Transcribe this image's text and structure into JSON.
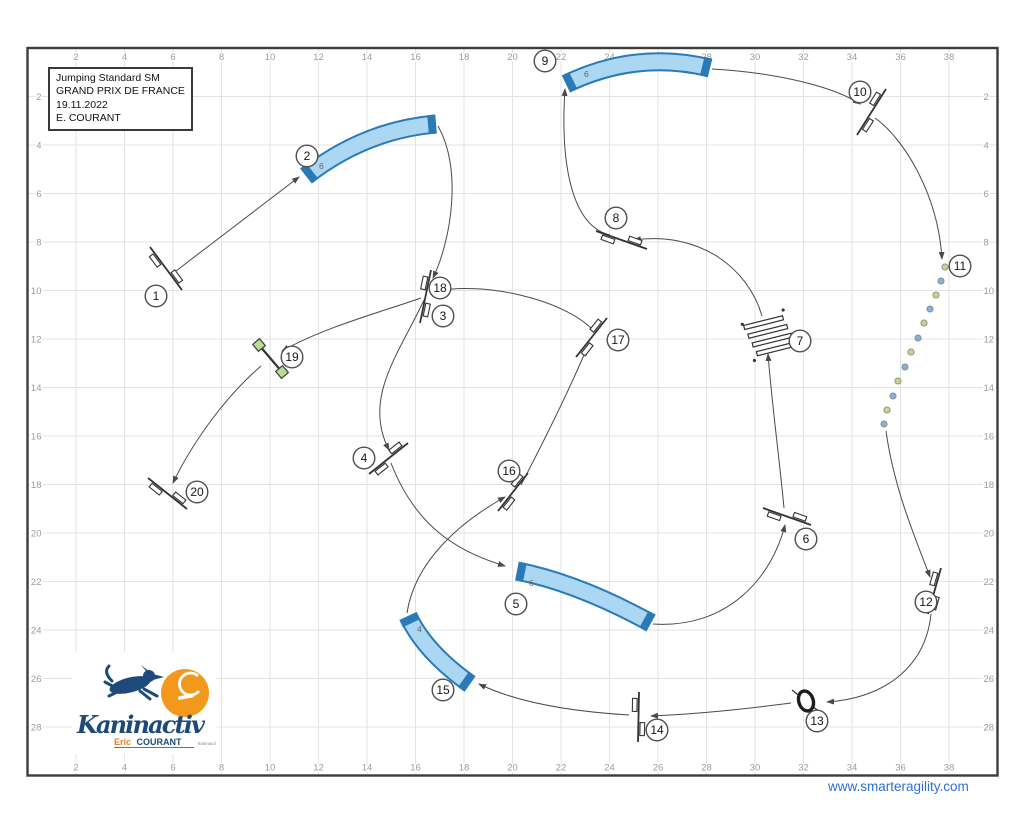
{
  "title_block": {
    "lines": [
      "Jumping Standard SM",
      "GRAND PRIX DE FRANCE",
      "19.11.2022",
      "E. COURANT"
    ]
  },
  "footer": {
    "website": "www.smarteragility.com"
  },
  "logo": {
    "name": "Kaninactiv",
    "subtitle_first": "Eric",
    "subtitle_last": "COURANT",
    "tagline": "kaninactiv"
  },
  "colors": {
    "frame": "#3c3c3c",
    "grid": "#e3e3e3",
    "axis_text": "#9b9b9b",
    "path": "#4a4a4a",
    "tunnel_fill": "#abd7f3",
    "tunnel_edge": "#2a7ab8",
    "tunnel_label": "#666666",
    "weave_green": "#c8d489",
    "weave_blue": "#82b1d9",
    "wall_green": "#b9dc92",
    "circle_stroke": "#4e4e4e",
    "circle_text": "#161616",
    "link_blue": "#2e6fd6",
    "logo_navy": "#1d4a7a",
    "logo_orange": "#f2991d"
  },
  "course": {
    "origin_x": 27.5,
    "origin_y": 48,
    "meter_px": 24.25,
    "width_m": 40,
    "height_m": 30,
    "x_ticks": [
      2,
      4,
      6,
      8,
      10,
      12,
      14,
      16,
      18,
      20,
      22,
      24,
      26,
      28,
      30,
      32,
      34,
      36,
      38
    ],
    "y_ticks": [
      2,
      4,
      6,
      8,
      10,
      12,
      14,
      16,
      18,
      20,
      22,
      24,
      26,
      28
    ],
    "legs": [
      {
        "from": "1",
        "to": "2",
        "d": "M176,271 L299,177"
      },
      {
        "from": "2",
        "to": "3",
        "d": "M438,126 C462,168 452,238 433,278"
      },
      {
        "from": "3",
        "to": "4",
        "d": "M424,300 C400,352 362,398 389,450"
      },
      {
        "from": "4",
        "to": "5",
        "d": "M391,463 C415,525 455,551 505,566"
      },
      {
        "from": "5",
        "to": "6",
        "d": "M653,624 C728,629 772,577 785,525"
      },
      {
        "from": "6",
        "to": "7",
        "d": "M784,508 C779,455 772,405 768,354"
      },
      {
        "from": "7",
        "to": "8",
        "d": "M762,316 C748,268 700,231 634,240"
      },
      {
        "from": "8",
        "to": "9",
        "d": "M610,235 C572,226 560,165 565,89"
      },
      {
        "from": "9",
        "to": "10",
        "d": "M712,69 C782,73 836,88 860,104"
      },
      {
        "from": "10",
        "to": "11",
        "d": "M875,118 C902,137 938,192 942,259"
      },
      {
        "from": "11",
        "to": "12",
        "d": "M886,431 C894,489 915,537 930,577"
      },
      {
        "from": "12",
        "to": "13",
        "d": "M931,614 C925,672 878,699 827,702"
      },
      {
        "from": "13",
        "to": "14",
        "d": "M791,703 C744,709 700,714 651,716"
      },
      {
        "from": "14",
        "to": "15",
        "d": "M629,715 C563,711 514,701 479,684"
      },
      {
        "from": "15",
        "to": "16",
        "d": "M407,613 C415,560 462,521 505,497"
      },
      {
        "from": "16",
        "to": "17",
        "d": "M521,485 C546,437 570,388 587,348"
      },
      {
        "from": "17",
        "to": "18",
        "d": "M593,330 C562,298 482,282 438,291"
      },
      {
        "from": "18",
        "to": "19",
        "d": "M421,298 C378,313 325,327 282,351"
      },
      {
        "from": "19",
        "to": "20",
        "d": "M261,366 C227,395 193,441 173,483"
      }
    ],
    "obstacles": [
      {
        "type": "jump",
        "num": "1",
        "x1": 150,
        "y1": 247,
        "x2": 182,
        "y2": 290,
        "circles": [
          {
            "n": "1",
            "x": 156,
            "y": 296
          }
        ]
      },
      {
        "type": "tunnel",
        "num": "2",
        "x0": 306,
        "y0": 176,
        "cx": 365,
        "cy": 130,
        "x1": 436,
        "y1": 124,
        "label": "6",
        "lx": 319,
        "ly": 169,
        "circles": [
          {
            "n": "2",
            "x": 307,
            "y": 156
          }
        ]
      },
      {
        "type": "jump",
        "num": "3/18",
        "x1": 431,
        "y1": 270,
        "x2": 420,
        "y2": 323,
        "circles": [
          {
            "n": "18",
            "x": 440,
            "y": 288
          },
          {
            "n": "3",
            "x": 443,
            "y": 316
          }
        ]
      },
      {
        "type": "jump",
        "num": "4",
        "x1": 408,
        "y1": 443,
        "x2": 369,
        "y2": 474,
        "circles": [
          {
            "n": "4",
            "x": 364,
            "y": 458
          }
        ]
      },
      {
        "type": "tunnel",
        "num": "5",
        "x0": 517,
        "y0": 571,
        "cx": 578,
        "cy": 583,
        "x1": 651,
        "y1": 623,
        "label": "6",
        "lx": 529,
        "ly": 586,
        "circles": [
          {
            "n": "5",
            "x": 516,
            "y": 604
          }
        ]
      },
      {
        "type": "jump",
        "num": "6",
        "x1": 763,
        "y1": 508,
        "x2": 811,
        "y2": 525,
        "circles": [
          {
            "n": "6",
            "x": 806,
            "y": 539
          }
        ]
      },
      {
        "type": "longjump",
        "num": "7",
        "cx": 770,
        "cy": 336,
        "angle": -14,
        "circles": [
          {
            "n": "7",
            "x": 800,
            "y": 341
          }
        ]
      },
      {
        "type": "jump",
        "num": "8",
        "x1": 596,
        "y1": 231,
        "x2": 647,
        "y2": 249,
        "circles": [
          {
            "n": "8",
            "x": 616,
            "y": 218
          }
        ]
      },
      {
        "type": "tunnel",
        "num": "9",
        "x0": 566,
        "y0": 84,
        "cx": 636,
        "cy": 50,
        "x1": 710,
        "y1": 68,
        "label": "6",
        "lx": 584,
        "ly": 77,
        "circles": [
          {
            "n": "9",
            "x": 545,
            "y": 61
          }
        ]
      },
      {
        "type": "jump",
        "num": "10",
        "x1": 886,
        "y1": 89,
        "x2": 857,
        "y2": 135,
        "circles": [
          {
            "n": "10",
            "x": 860,
            "y": 92
          }
        ]
      },
      {
        "type": "weave",
        "num": "11",
        "poles": [
          [
            945,
            267,
            "g"
          ],
          [
            941,
            281,
            "b"
          ],
          [
            936,
            295,
            "g"
          ],
          [
            930,
            309,
            "b"
          ],
          [
            924,
            323,
            "g"
          ],
          [
            918,
            338,
            "b"
          ],
          [
            911,
            352,
            "g"
          ],
          [
            905,
            367,
            "b"
          ],
          [
            898,
            381,
            "g"
          ],
          [
            893,
            396,
            "b"
          ],
          [
            887,
            410,
            "g"
          ],
          [
            884,
            424,
            "b"
          ]
        ],
        "circles": [
          {
            "n": "11",
            "x": 960,
            "y": 266
          }
        ]
      },
      {
        "type": "jump",
        "num": "12",
        "x1": 941,
        "y1": 568,
        "x2": 928,
        "y2": 614,
        "circles": [
          {
            "n": "12",
            "x": 926,
            "y": 602
          }
        ]
      },
      {
        "type": "tire",
        "num": "13",
        "cx": 806,
        "cy": 701,
        "circles": [
          {
            "n": "13",
            "x": 817,
            "y": 721
          }
        ]
      },
      {
        "type": "jump",
        "num": "14",
        "x1": 639,
        "y1": 692,
        "x2": 638,
        "y2": 742,
        "circles": [
          {
            "n": "14",
            "x": 657,
            "y": 730
          }
        ]
      },
      {
        "type": "tunnel",
        "num": "15",
        "x0": 408,
        "y0": 616,
        "cx": 425,
        "cy": 652,
        "x1": 470,
        "y1": 684,
        "label": "4",
        "lx": 417,
        "ly": 632,
        "circles": [
          {
            "n": "15",
            "x": 443,
            "y": 690
          }
        ]
      },
      {
        "type": "jump",
        "num": "16",
        "x1": 528,
        "y1": 473,
        "x2": 498,
        "y2": 511,
        "circles": [
          {
            "n": "16",
            "x": 509,
            "y": 471
          }
        ]
      },
      {
        "type": "jump",
        "num": "17",
        "x1": 607,
        "y1": 318,
        "x2": 576,
        "y2": 357,
        "circles": [
          {
            "n": "17",
            "x": 618,
            "y": 340
          }
        ]
      },
      {
        "type": "wall",
        "num": "19",
        "x1": 259,
        "y1": 345,
        "x2": 282,
        "y2": 372,
        "circles": [
          {
            "n": "19",
            "x": 292,
            "y": 357
          }
        ]
      },
      {
        "type": "jump",
        "num": "20",
        "x1": 148,
        "y1": 478,
        "x2": 187,
        "y2": 509,
        "circles": [
          {
            "n": "20",
            "x": 197,
            "y": 492
          }
        ]
      }
    ]
  }
}
